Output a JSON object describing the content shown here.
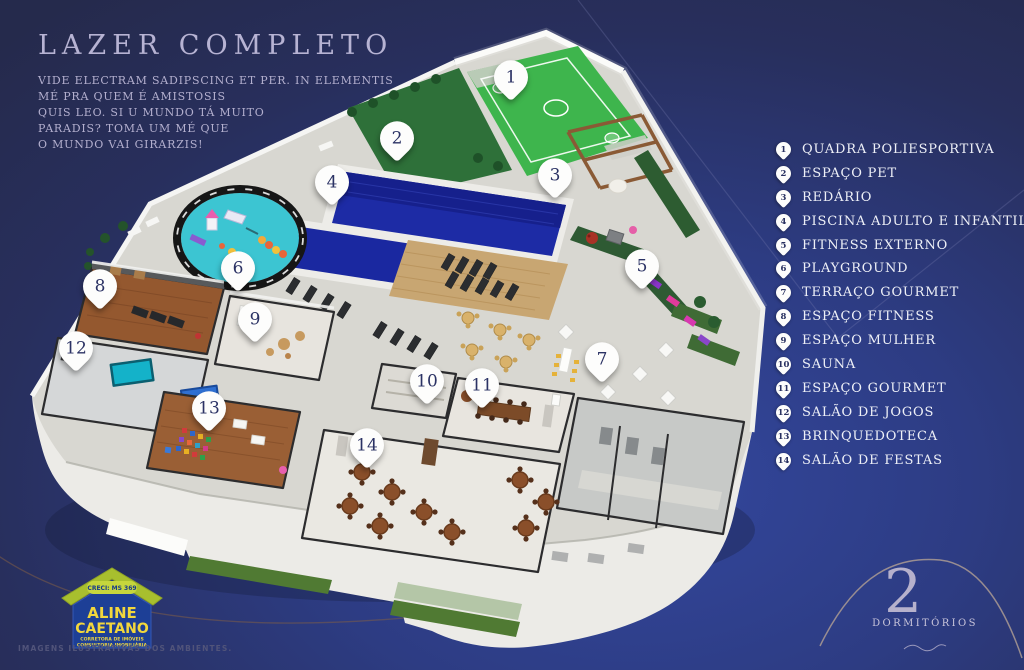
{
  "header": {
    "title": "LAZER COMPLETO",
    "subtitle_lines": [
      "VIDE ELECTRAM SADIPSCING ET PER. IN ELEMENTIS",
      "MÉ PRA QUEM É AMISTOSIS",
      "QUIS LEO. SI U MUNDO TÁ MUITO",
      "PARADIS? TOMA UM MÉ QUE",
      "O MUNDO VAI GIRARZIS!"
    ]
  },
  "legend": {
    "items": [
      {
        "number": "1",
        "label": "QUADRA POLIESPORTIVA"
      },
      {
        "number": "2",
        "label": "ESPAÇO PET"
      },
      {
        "number": "3",
        "label": "REDÁRIO"
      },
      {
        "number": "4",
        "label": "PISCINA ADULTO E INFANTIL"
      },
      {
        "number": "5",
        "label": "FITNESS EXTERNO"
      },
      {
        "number": "6",
        "label": "PLAYGROUND"
      },
      {
        "number": "7",
        "label": "TERRAÇO GOURMET"
      },
      {
        "number": "8",
        "label": "ESPAÇO FITNESS"
      },
      {
        "number": "9",
        "label": "ESPAÇO MULHER"
      },
      {
        "number": "10",
        "label": "SAUNA"
      },
      {
        "number": "11",
        "label": "ESPAÇO GOURMET"
      },
      {
        "number": "12",
        "label": "SALÃO DE JOGOS"
      },
      {
        "number": "13",
        "label": "BRINQUEDOTECA"
      },
      {
        "number": "14",
        "label": "SALÃO DE FESTAS"
      }
    ]
  },
  "logo": {
    "creci": "CRECI: MS 369",
    "name_line1": "ALINE",
    "name_line2": "CAETANO",
    "tagline1": "CORRETORA DE IMÓVEIS",
    "tagline2": "CONSULTORIA IMOBILIÁRIA"
  },
  "badge": {
    "number": "2",
    "label": "DORMITÓRIOS"
  },
  "footer": {
    "disclaimer": "IMAGENS ILUSTRATIVAS DOS AMBIENTES."
  },
  "colors": {
    "background": "#2d3c83",
    "title_text": "#b7b3d3",
    "legend_text": "#eef0f7",
    "pool_blue": "#1d2ba5",
    "court_green": "#3eb54d",
    "playground_teal": "#3cc5d2",
    "logo_yellow": "#f2d73c",
    "logo_blue": "#1d3f96"
  }
}
